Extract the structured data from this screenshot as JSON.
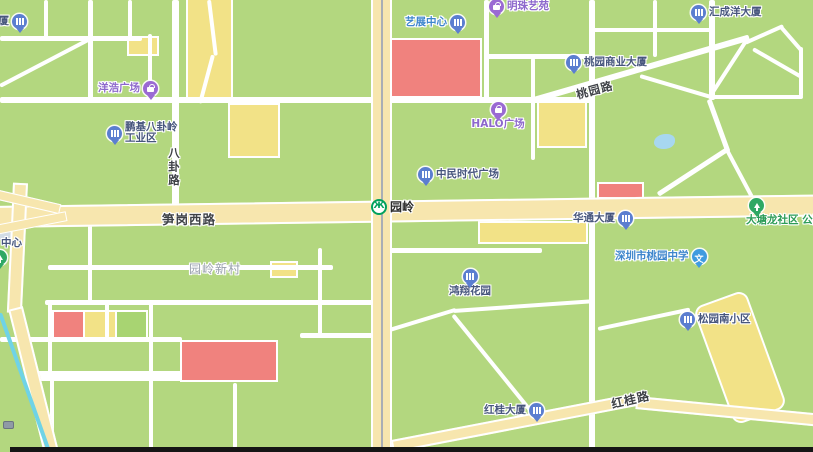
{
  "pois": [
    {
      "label": "大厦",
      "type": "building"
    },
    {
      "label": "洋浩广场",
      "type": "shopping"
    },
    {
      "label": "鹏基八卦岭",
      "label2": "工业区",
      "type": "building"
    },
    {
      "label": "艺展中心",
      "type": "building"
    },
    {
      "label": "明珠艺苑",
      "type": "shopping"
    },
    {
      "label": "HALO广场",
      "type": "shopping"
    },
    {
      "label": "汇成洋大厦",
      "type": "building"
    },
    {
      "label": "桃园商业大厦",
      "type": "building"
    },
    {
      "label": "中民时代广场",
      "type": "building"
    },
    {
      "label": "华通大厦",
      "type": "building"
    },
    {
      "label": "大塘龙社区 公园",
      "type": "park"
    },
    {
      "label": "深圳市桃园中学",
      "type": "school"
    },
    {
      "label": "鸿翔花园",
      "type": "building"
    },
    {
      "label": "松园南小区",
      "type": "building"
    },
    {
      "label": "红桂大厦",
      "type": "building"
    },
    {
      "label": "中心",
      "type": "park"
    }
  ],
  "roads": {
    "sungang_west": "笋岗西路",
    "bagua": "八卦路",
    "taoyuan": "桃园路",
    "honggui": "红桂路"
  },
  "areas": {
    "yuanling_xincun": "园岭新村"
  },
  "metro": {
    "station": "园岭"
  },
  "colors": {
    "land": "#b3d77f",
    "road_major": "#f7e6ae",
    "block_red": "#f0827e",
    "block_yellow": "#f2e287",
    "water": "#a7d7f0",
    "transit_line": "#6fd3e6",
    "metro_green": "#00a15e"
  }
}
